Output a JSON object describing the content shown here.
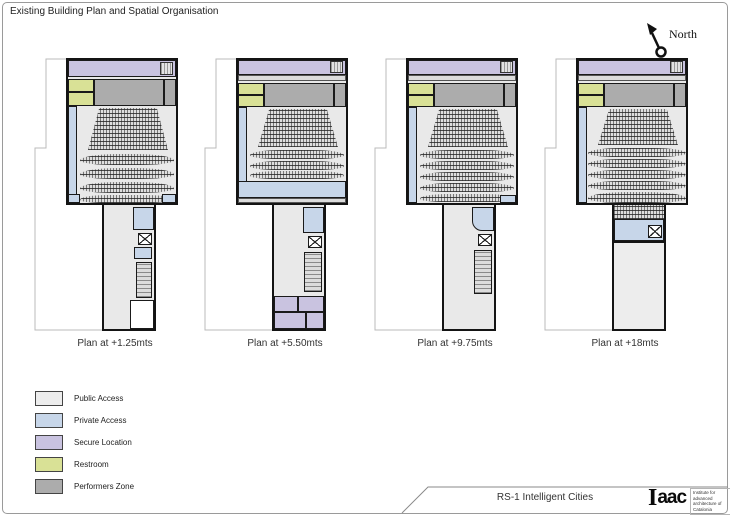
{
  "sheet": {
    "title": "Existing Building Plan and Spatial Organisation",
    "north_label": "North"
  },
  "plans": {
    "captions": [
      "Plan at +1.25mts",
      "Plan at +5.50mts",
      "Plan at +9.75mts",
      "Plan at +18mts"
    ]
  },
  "legend": {
    "labels": [
      "Public Access",
      "Private Access",
      "Secure Location",
      "Restroom",
      "Performers Zone"
    ]
  },
  "colors": {
    "public": "#ededed",
    "private": "#c7d6e9",
    "secure": "#c9c3e0",
    "restroom": "#d9e196",
    "performers": "#acacac"
  },
  "footer": {
    "project": "RS-1 Intelligent Cities",
    "logo_i": "I",
    "logo_rest": "aac",
    "logo_caption": "Institute for advanced architecture of Catalonia"
  }
}
